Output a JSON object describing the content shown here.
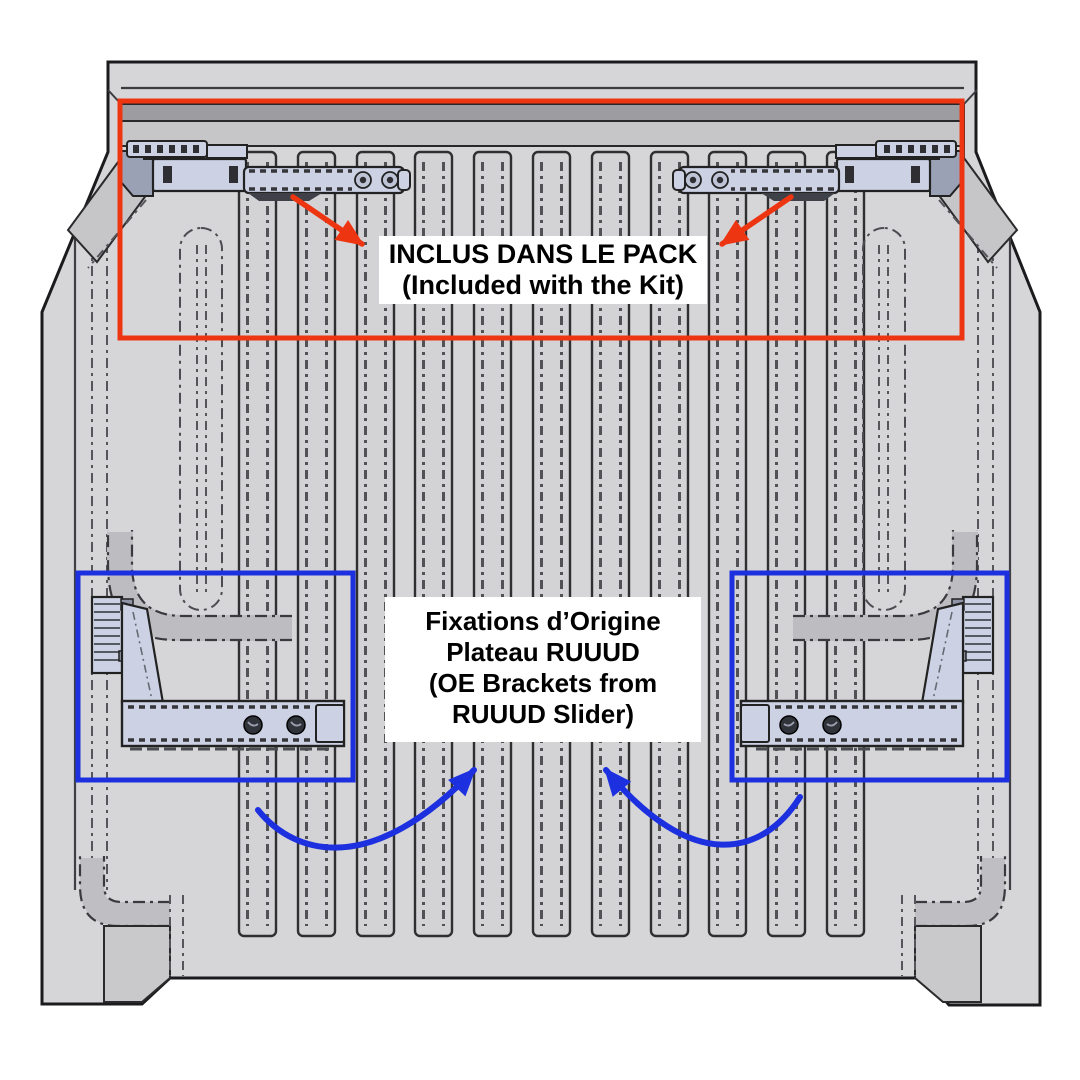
{
  "image_type": "bracket-installation-diagram",
  "colors": {
    "kit_annotation_red": "#ee3512",
    "oe_annotation_blue": "#1c30e0",
    "bed_gray": "#d6d6d8",
    "bracket_lavender": "#ccd2e4",
    "label_background": "#ffffff",
    "label_text": "#000000"
  },
  "annotations": {
    "kit": {
      "line_fr": "INCLUS DANS LE PACK",
      "line_en": "(Included with the Kit)"
    },
    "oe": {
      "lines": [
        "Fixations d’Origine",
        "Plateau RUUUD",
        "(OE Brackets from",
        "RUUUD Slider)"
      ]
    }
  }
}
